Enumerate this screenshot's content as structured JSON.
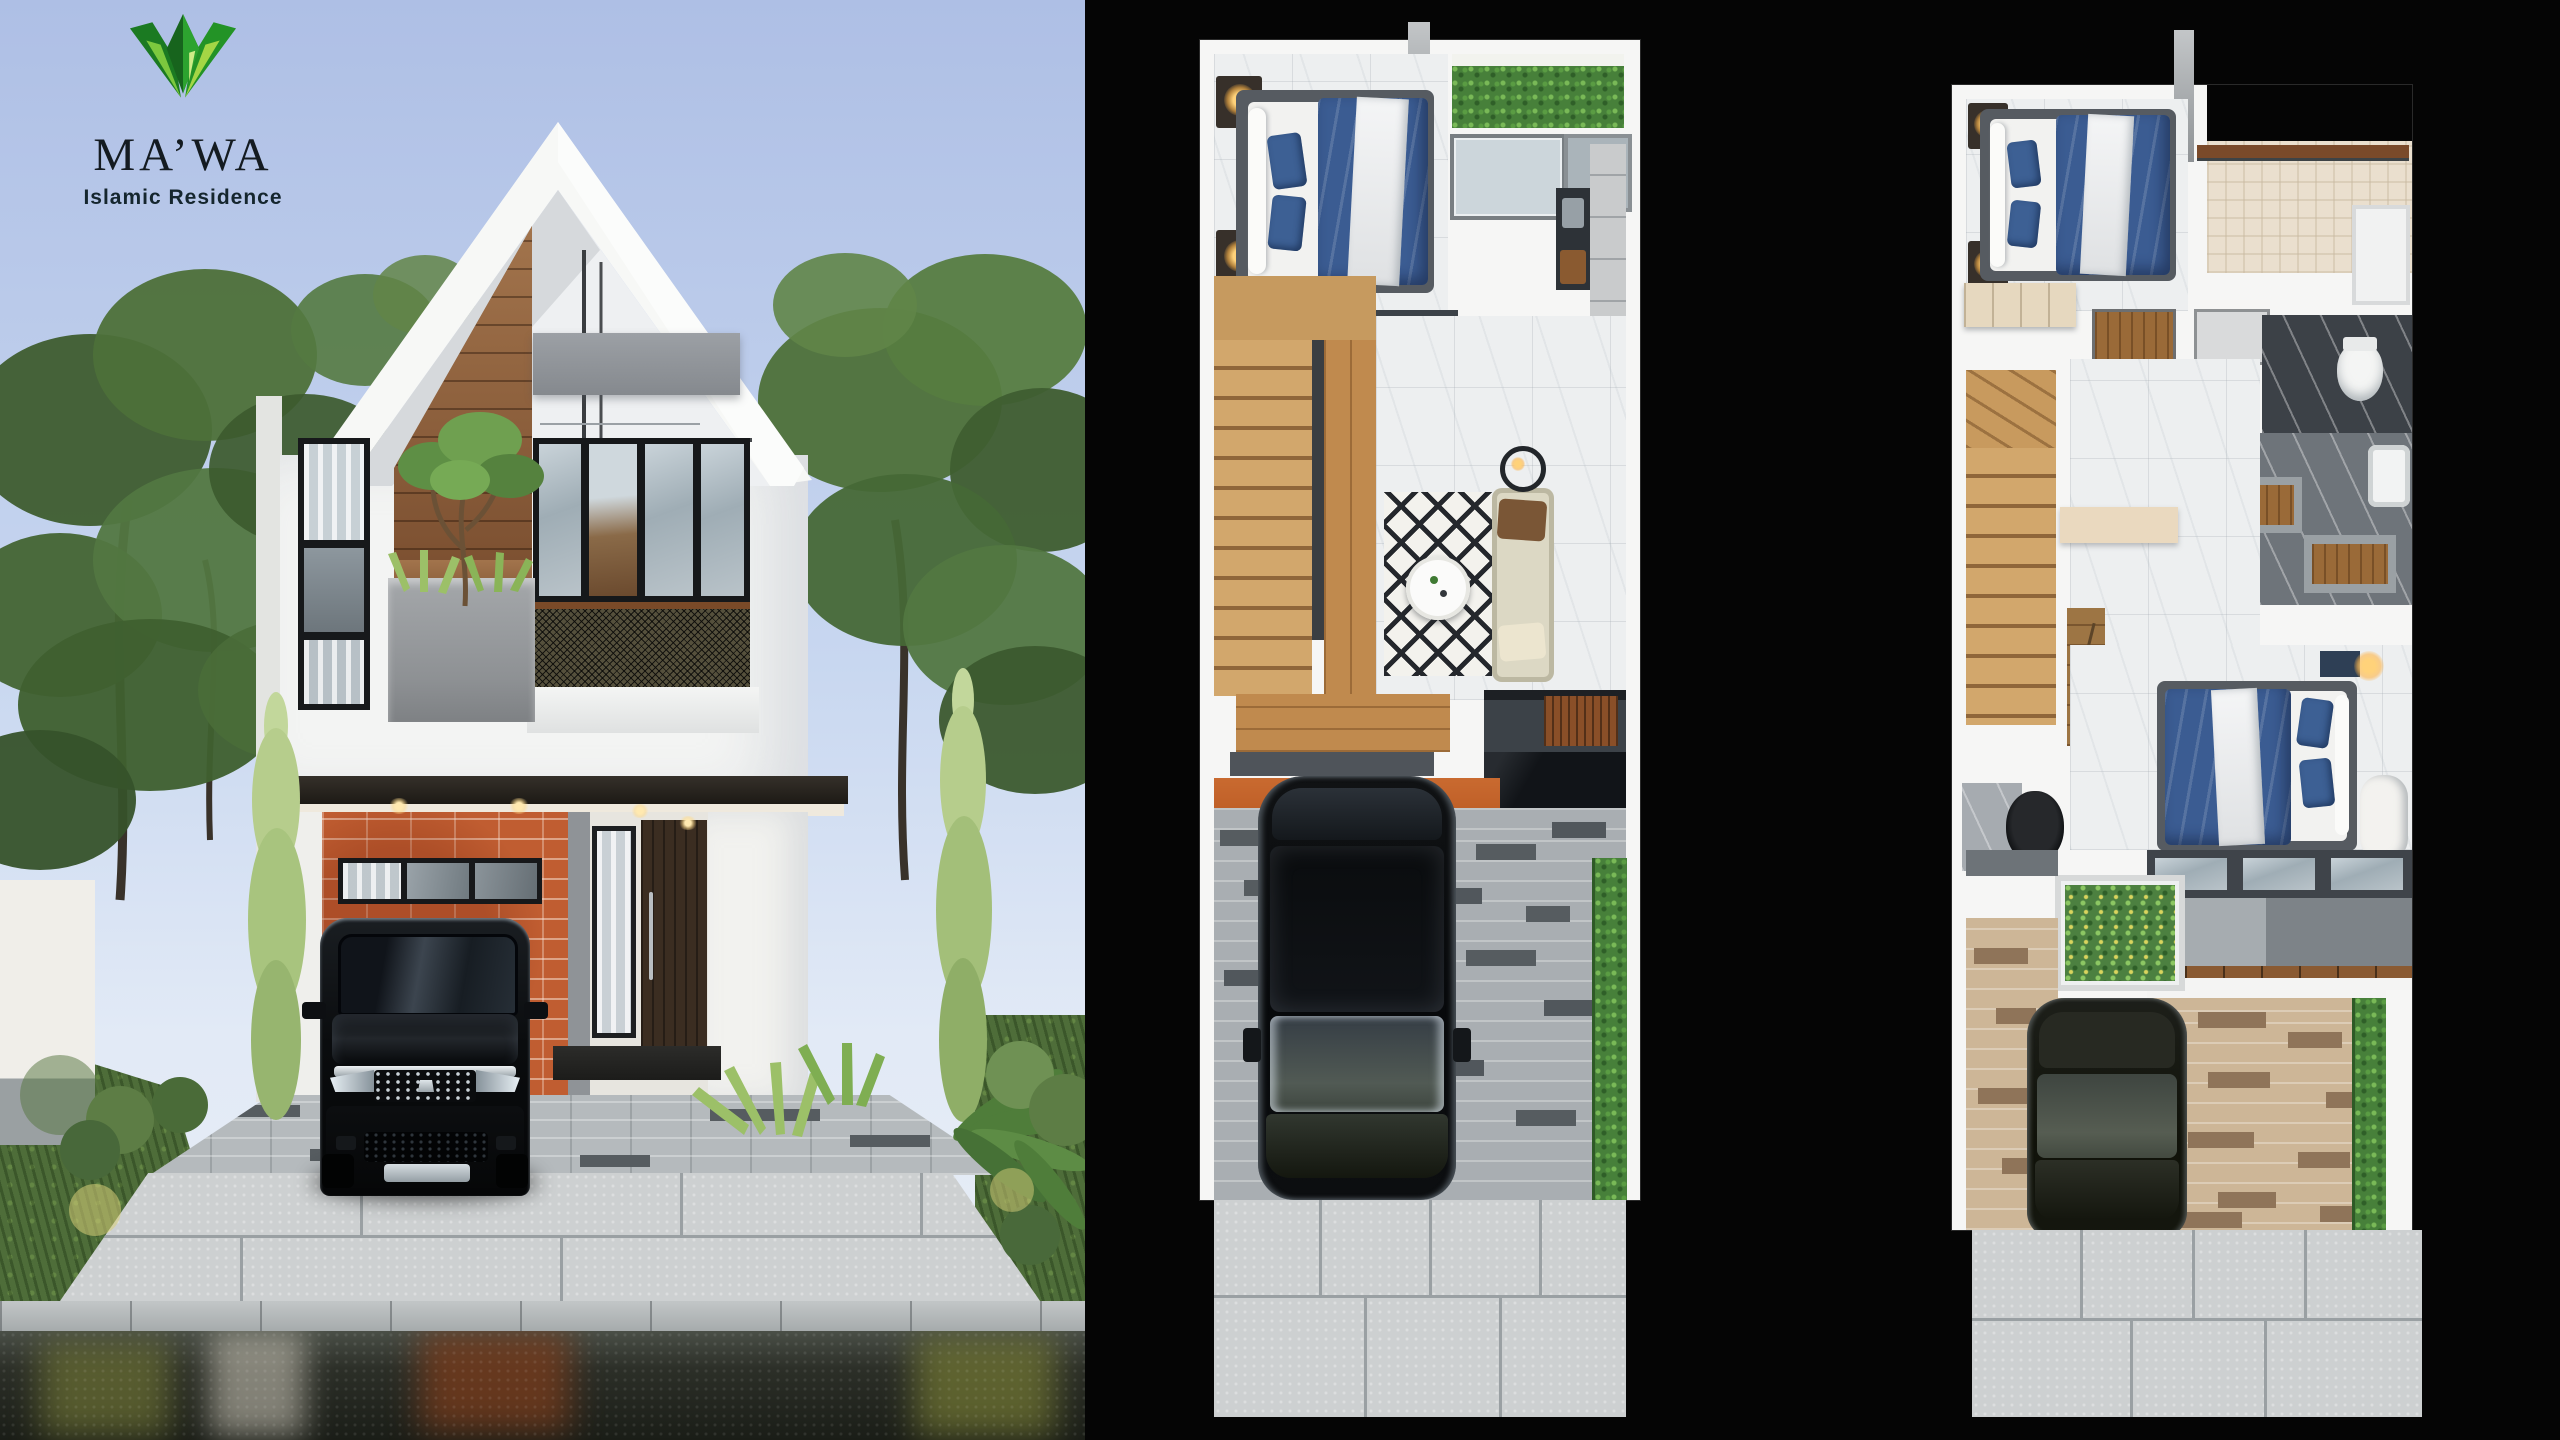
{
  "brand": {
    "logo_icon": "leaf-crown-icon",
    "name": "MA’WA",
    "tagline": "Islamic Residence"
  },
  "colors": {
    "canvas_bg": "#050505",
    "sky_top": "#aebfe5",
    "sky_mid": "#c8d7f0",
    "sky_low": "#e2eaf6",
    "roof_white": "#f7f8f6",
    "wall_white": "#f3f4f3",
    "gray_panel": "#8f9397",
    "wood": "#99663f",
    "plank_wood": "#c08a4e",
    "brick": "#c05d31",
    "door_brown": "#3b2d21",
    "fascia_dark": "#272219",
    "car_black": "#0b0d0f",
    "grass": "#4e6d39",
    "tree_dark": "#3c5a2e",
    "tree_mid": "#4d7039",
    "tree_light": "#618548",
    "cypress_light": "#b6cd8c",
    "paver_light": "#b5babd",
    "paver_dark": "#545a5f",
    "slab": "#cdd0d1",
    "curb": "#b6babb",
    "road": "#23261f",
    "plan_wall": "#f6f6f5",
    "marble": "#edeff0",
    "bed_frame": "#565b61",
    "bed_blue": "#3b5c92",
    "pillow_blue": "#3d6094",
    "stair_wood": "#d2a76c",
    "stair_edge": "#8f663a",
    "rug_base": "#f3f2ed",
    "rug_dark": "#24272c",
    "sofa": "#dcd8c4",
    "counter_light": "#c9cbcc",
    "counter_dark": "#2d3237",
    "navy_cabinet": "#33516b",
    "dresser_wood": "#a9713d",
    "plant_green": "#47803a",
    "plant_light": "#79b957",
    "tan_paver": "#cdb697",
    "tan_dark": "#8f7459",
    "balcony_gray": "#9aa0a4",
    "threshold": "#c06028",
    "gold": "#ffd27a",
    "brand_dark": "#141b21",
    "brand_green": "#239326",
    "brand_green_light": "#8ad03e"
  }
}
